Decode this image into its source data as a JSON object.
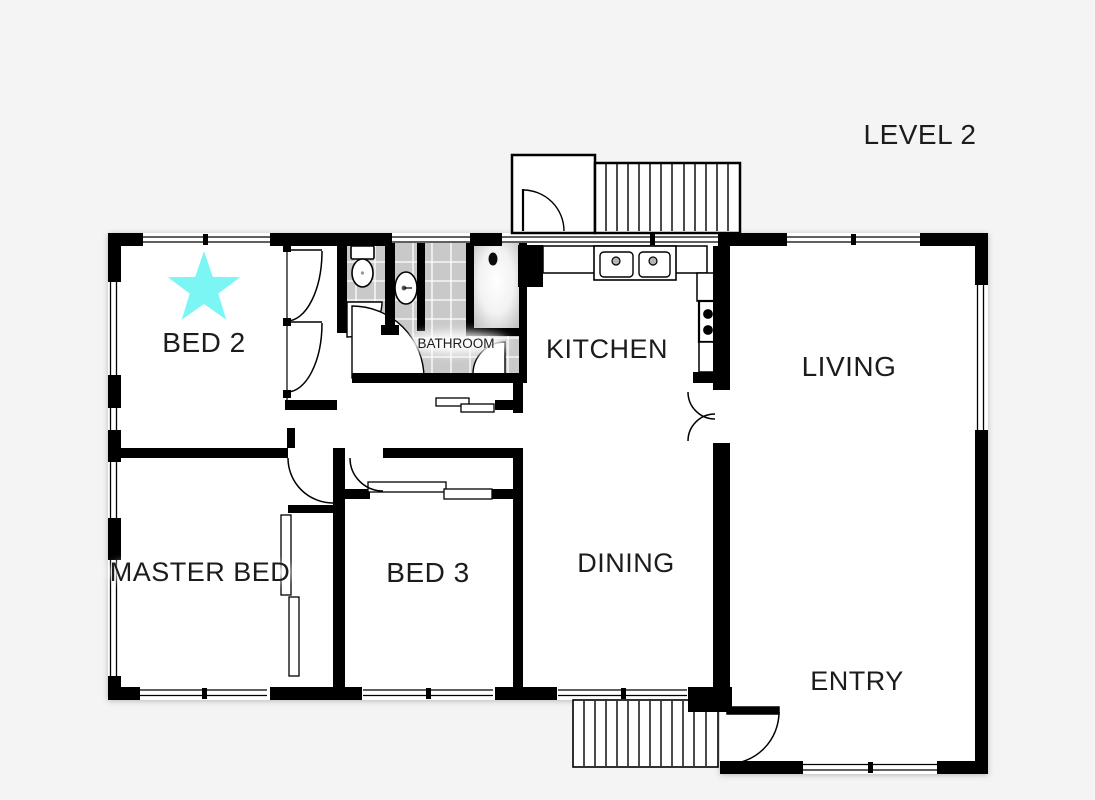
{
  "title": "LEVEL 2",
  "rooms": [
    {
      "label": "BED 2"
    },
    {
      "label": "MASTER BED"
    },
    {
      "label": "BED 3"
    },
    {
      "label": "BATHROOM"
    },
    {
      "label": "KITCHEN"
    },
    {
      "label": "DINING"
    },
    {
      "label": "LIVING"
    },
    {
      "label": "ENTRY"
    }
  ],
  "colors": {
    "background": "#f4f4f4",
    "floor": "#ffffff",
    "wall": "#000000",
    "tile": "#c9c9c9",
    "grout": "#ffffff",
    "star": "#7cf5f5",
    "text": "#1c1c1c"
  },
  "icons": {
    "star": "highlight-star",
    "toilet": "toilet",
    "vanity_sink": "vanity-sink",
    "bathtub": "bathtub-shower",
    "kitchen_sink": "double-kitchen-sink",
    "stove": "four-burner-stove",
    "stairs_upper": "stairs-up",
    "stairs_lower": "stairs-entry"
  }
}
